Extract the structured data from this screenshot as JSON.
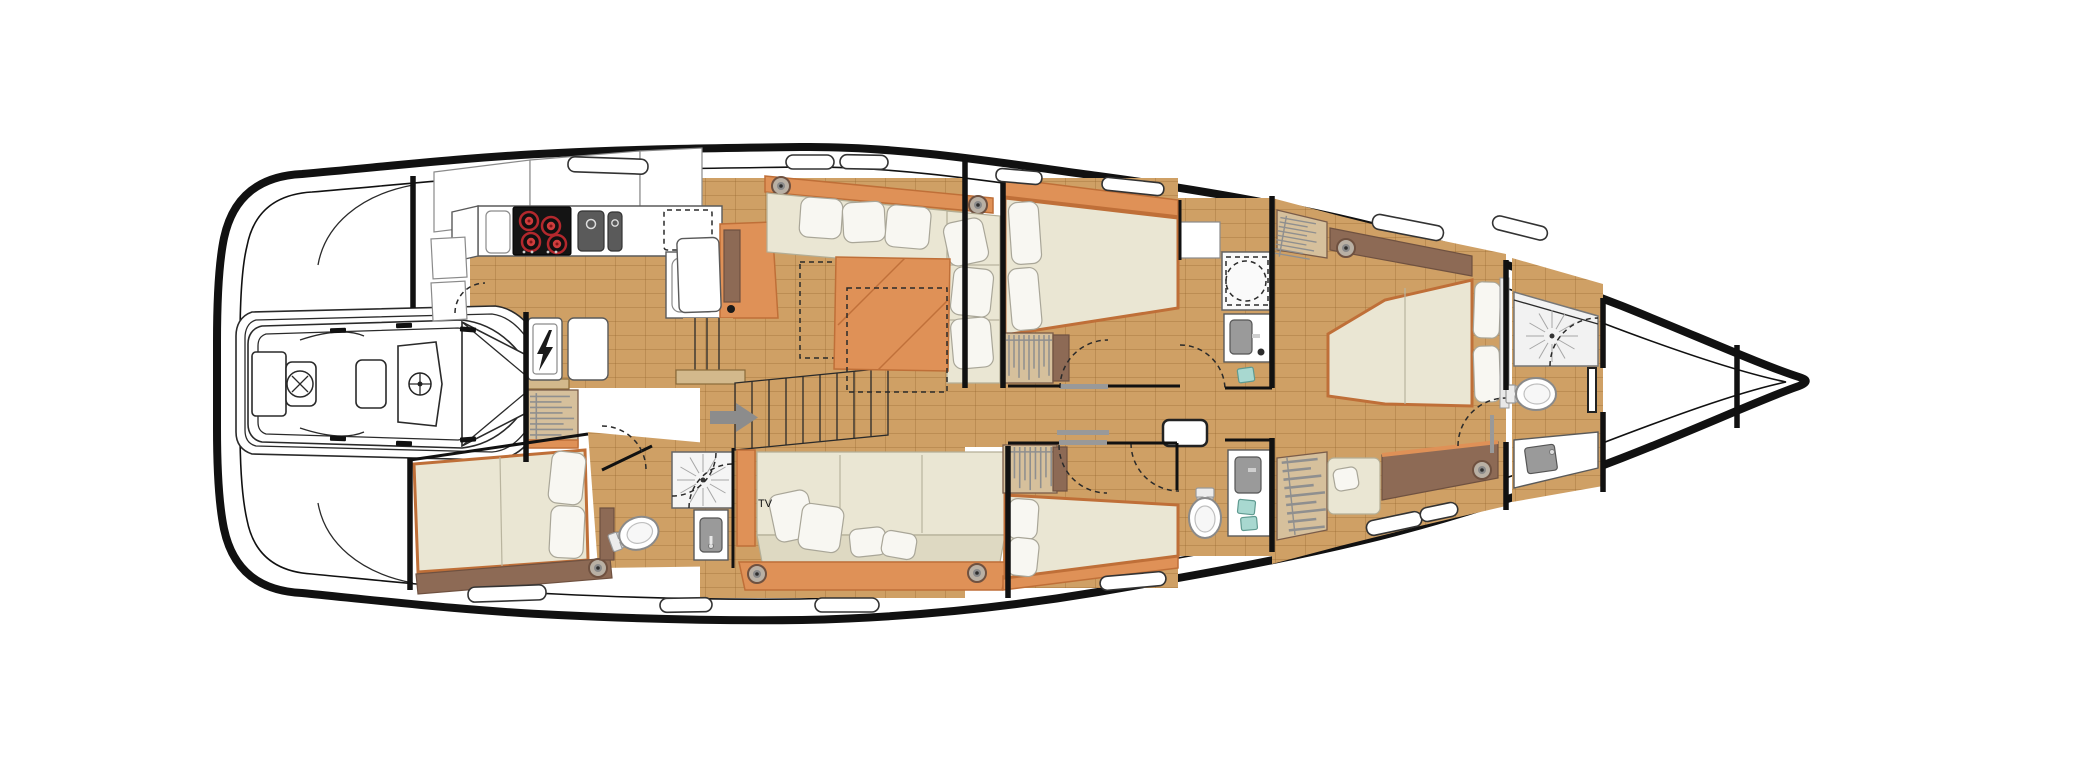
{
  "labels": {
    "tv": "TV"
  },
  "colors": {
    "ink": "#111111",
    "floor": "#cfa065",
    "floor_seam": "#8a5c24",
    "orange": "#df9157",
    "orange_dark": "#bf6f38",
    "brown": "#8d6a55",
    "brown_dark": "#6f5140",
    "cream": "#eae6d3",
    "appliance_gray": "#5a5a5a",
    "cooktop_black": "#141414",
    "burner_red": "#c23333",
    "soap_teal": "#a8d8d0",
    "hardware_gray": "#9a9a9a"
  },
  "icons": {
    "electrical_panel": "lightning-bolt",
    "wardrobe": "hanger-rail",
    "speaker": "concentric-circles",
    "shower": "sunburst-drain",
    "stove": "four-red-burners",
    "companionway": "right-arrow"
  }
}
